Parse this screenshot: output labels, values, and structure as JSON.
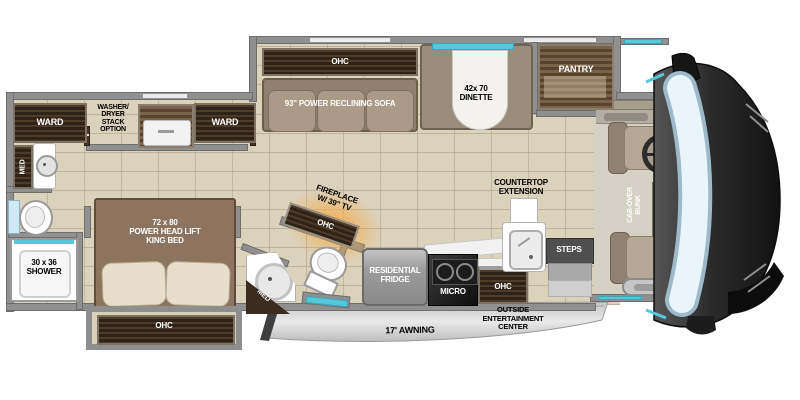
{
  "areas": {
    "living": {
      "ohc": "OHC",
      "sofa": "93\" POWER RECLINING SOFA",
      "dinette": "42x 70\nDINETTE",
      "pantry": "PANTRY"
    },
    "wardrobe_slide": {
      "ward_left": "WARD",
      "washer_dryer": "WASHER/\nDRYER\nSTACK\nOPTION",
      "ward_right": "WARD"
    },
    "front_bath": {
      "med": "MED",
      "shower": "30 x 36\nSHOWER"
    },
    "bedroom": {
      "bed": "72 x 80\nPOWER HEAD LIFT\nKING BED",
      "ohc": "OHC"
    },
    "mid_bath": {
      "med": "MED"
    },
    "entertainment": {
      "fireplace": "FIREPLACE\nW/ 39\" TV",
      "ohc": "OHC"
    },
    "kitchen": {
      "fridge": "RESIDENTIAL\nFRIDGE",
      "micro": "MICRO",
      "ohc": "OHC",
      "countertop": "COUNTERTOP\nEXTENSION",
      "steps": "STEPS"
    },
    "cab": {
      "bunk": "CAB-OVER\nBUNK"
    },
    "exterior": {
      "awning": "17' AWNING",
      "entertainment_center": "OUTSIDE\nENTERTAINMENT\nCENTER"
    }
  },
  "colors": {
    "floor": "#dbd2bc",
    "wall": "#909090",
    "dark_wood": "#3f3125",
    "window_teal": "#56c7d9",
    "glow_orange": "#f7a43c",
    "awning_gray": "#d6d6d6",
    "cap_dark": "#2a2a2a",
    "windshield": "#ddeef8"
  }
}
